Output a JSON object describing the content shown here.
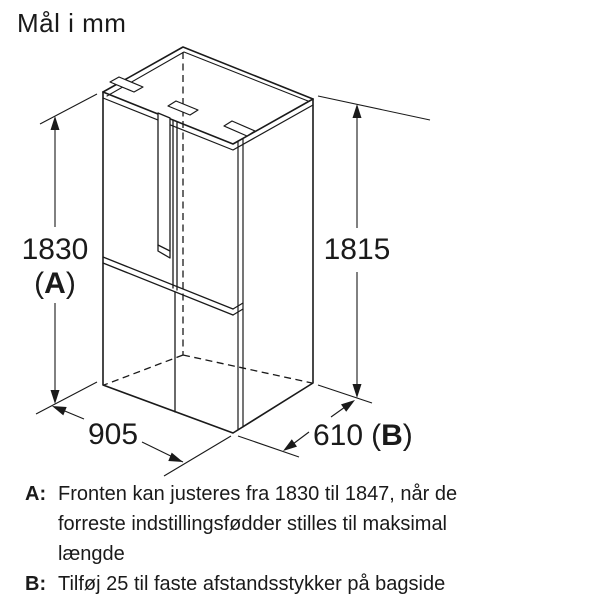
{
  "title": "Mål i mm",
  "dimensions": {
    "front_height": {
      "value": "1830",
      "open_paren": "(",
      "letter": "A",
      "close_paren": ")"
    },
    "side_height": {
      "value": "1815"
    },
    "width": {
      "value": "905"
    },
    "depth": {
      "value": "610",
      "open_paren": "(",
      "letter": "B",
      "close_paren": ")"
    }
  },
  "notes": {
    "a": {
      "label": "A:",
      "lines": [
        "Fronten kan justeres fra 1830 til 1847, når de",
        "forreste indstillingsfødder stilles til maksimal",
        "længde"
      ]
    },
    "b": {
      "label": "B:",
      "lines": [
        "Tilføj 25 til faste afstandsstykker på bagside"
      ]
    }
  }
}
